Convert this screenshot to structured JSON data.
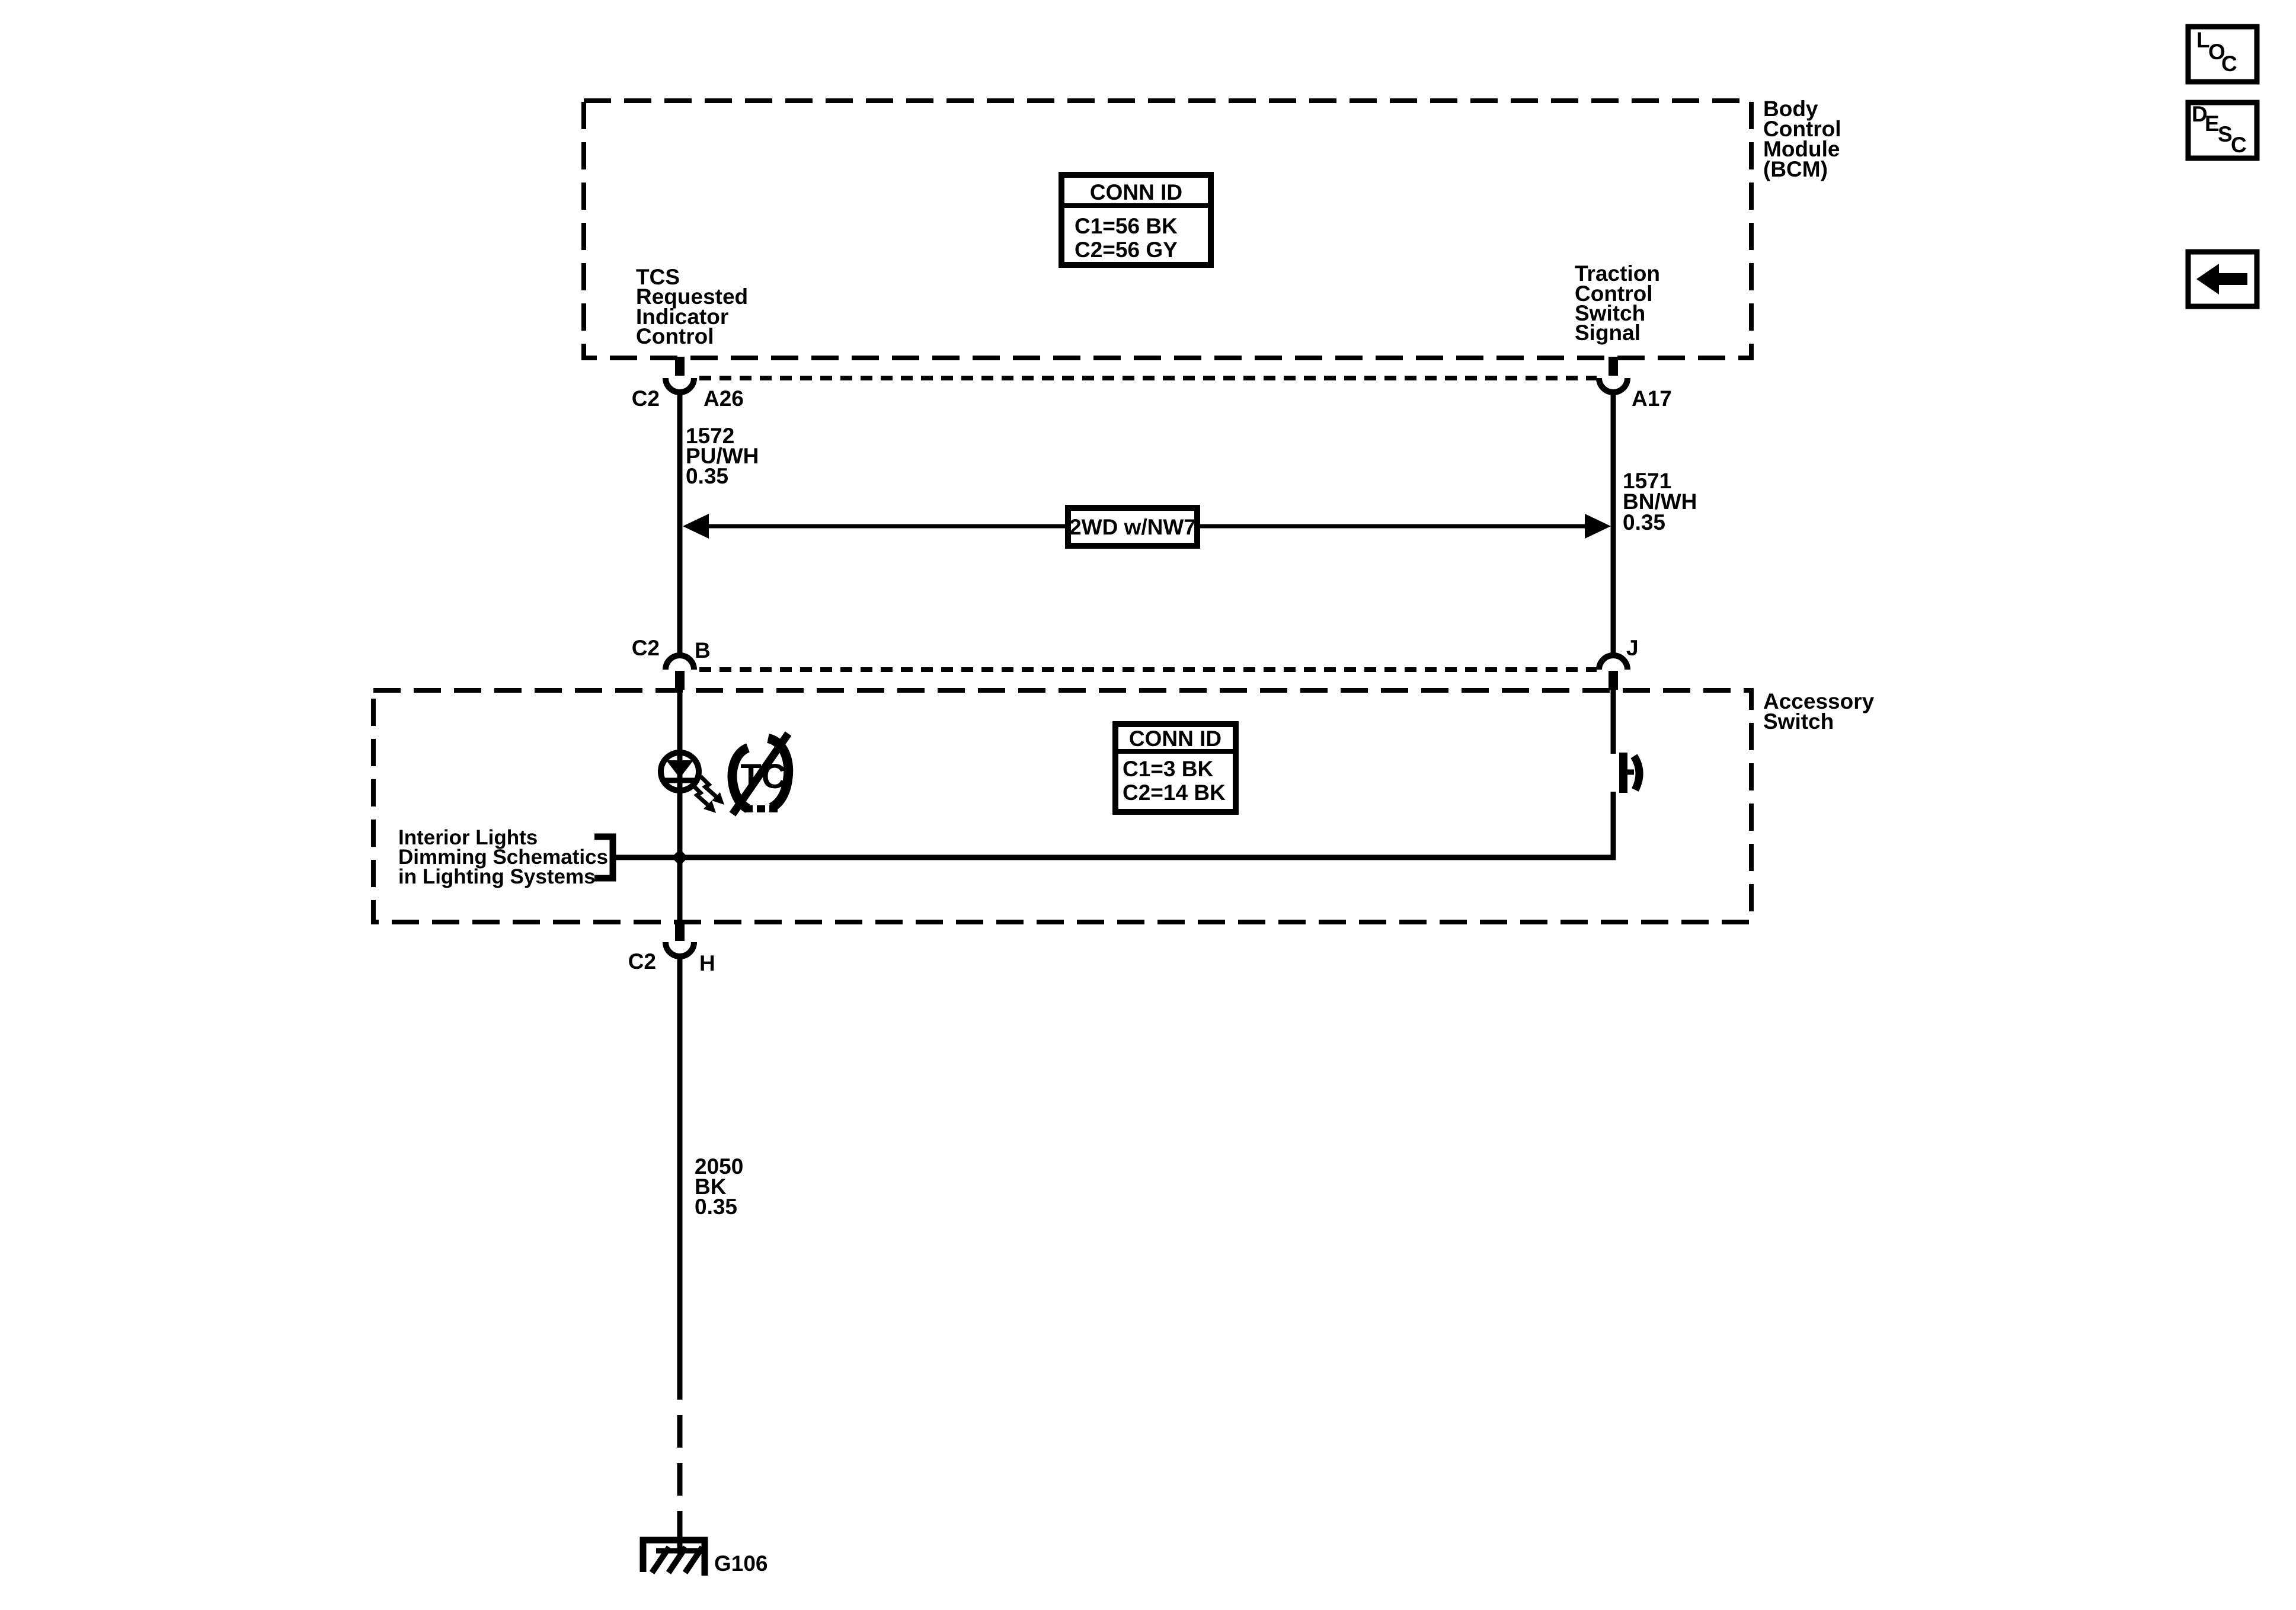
{
  "diagram": {
    "bcm": {
      "name_lines": [
        "Body",
        "Control",
        "Module",
        "(BCM)"
      ],
      "conn_id_title": "CONN ID",
      "conn_id_rows": [
        "C1=56 BK",
        "C2=56 GY"
      ],
      "left_pin_function": [
        "TCS",
        "Requested",
        "Indicator",
        "Control"
      ],
      "right_pin_function": [
        "Traction",
        "Control",
        "Switch",
        "Signal"
      ]
    },
    "row1": {
      "left_conn": "C2",
      "left_pin": "A26",
      "right_pin": "A17"
    },
    "left_wire": [
      "1572",
      "PU/WH",
      "0.35"
    ],
    "right_wire": [
      "1571",
      "BN/WH",
      "0.35"
    ],
    "option_label": "2WD w/NW7",
    "row2": {
      "left_conn": "C2",
      "left_pin": "B",
      "right_pin": "J"
    },
    "acc": {
      "name_lines": [
        "Accessory",
        "Switch"
      ],
      "conn_id_title": "CONN ID",
      "conn_id_rows": [
        "C1=3 BK",
        "C2=14 BK"
      ],
      "tc_text": "TC"
    },
    "note_lines": [
      "Interior Lights",
      "Dimming Schematics",
      "in Lighting Systems"
    ],
    "row3": {
      "conn": "C2",
      "pin": "H"
    },
    "ground_wire": [
      "2050",
      "BK",
      "0.35"
    ],
    "ground_id": "G106"
  },
  "rail": {
    "loc_letters": [
      "L",
      "O",
      "C"
    ],
    "desc_letters": [
      "D",
      "E",
      "S",
      "C"
    ]
  },
  "colors": {
    "ink": "#000000",
    "paper": "#ffffff"
  }
}
